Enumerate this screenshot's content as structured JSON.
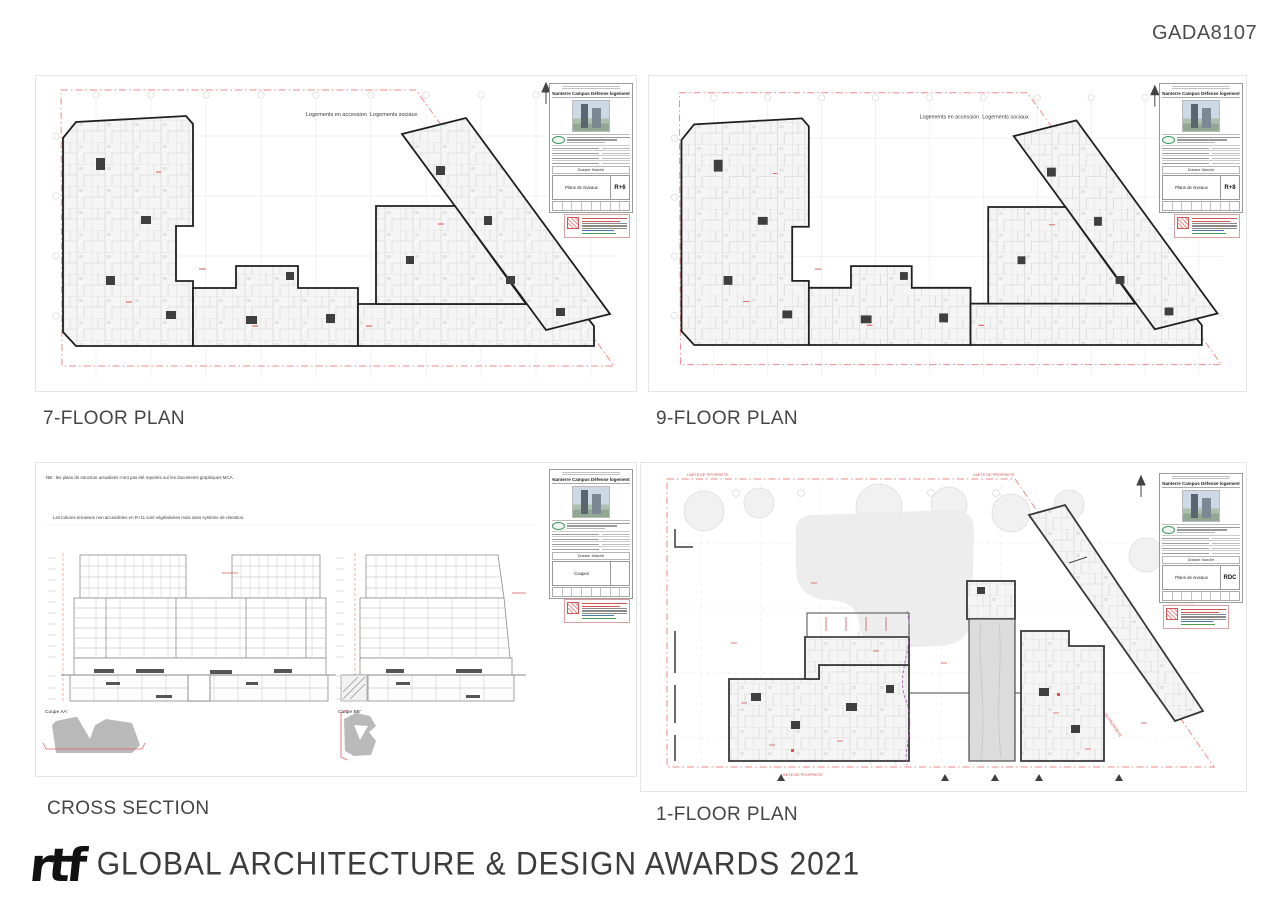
{
  "page": {
    "code": "GADA8107"
  },
  "footer": {
    "logo_text": "rtf",
    "award_text": "GLOBAL ARCHITECTURE & DESIGN AWARDS 2021"
  },
  "titleblock": {
    "project": "Nanterre Campus Défense logement",
    "dossier_label": "Dossier Marché"
  },
  "panels": {
    "plan7": {
      "caption": "7-FLOOR PLAN",
      "doc_label": "Plans de niveaux",
      "level": "R+6",
      "label_accession": "Logements en accession",
      "label_sociaux": "Logements sociaux"
    },
    "plan9": {
      "caption": "9-FLOOR PLAN",
      "doc_label": "Plans de niveaux",
      "level": "R+8",
      "label_accession": "Logements en accession",
      "label_sociaux": "Logements sociaux"
    },
    "section": {
      "caption": "CROSS SECTION",
      "doc_label": "Coupes",
      "level": "",
      "note1": "NB : les plans de structure actualisés n'ont pas été reportés sur les documents graphiques MCA.",
      "note2": "Les toitures terrasses non accessibles en R+11 sont végétalisées mais sans système de rétention.",
      "coupe_a": "Coupe AA'",
      "coupe_b": "Coupe BB'"
    },
    "plan1": {
      "caption": "1-FLOOR PLAN",
      "doc_label": "Plans de niveaux",
      "level": "RDC",
      "limite": "LIMITE DE PROPRIETE"
    }
  },
  "colors": {
    "boundary_red": "#ef8a8a",
    "annotation_red": "#d9534f",
    "logo_green": "#3f9460",
    "walls_ink": "#1f1f1f",
    "path_purple": "#a85fa8"
  }
}
